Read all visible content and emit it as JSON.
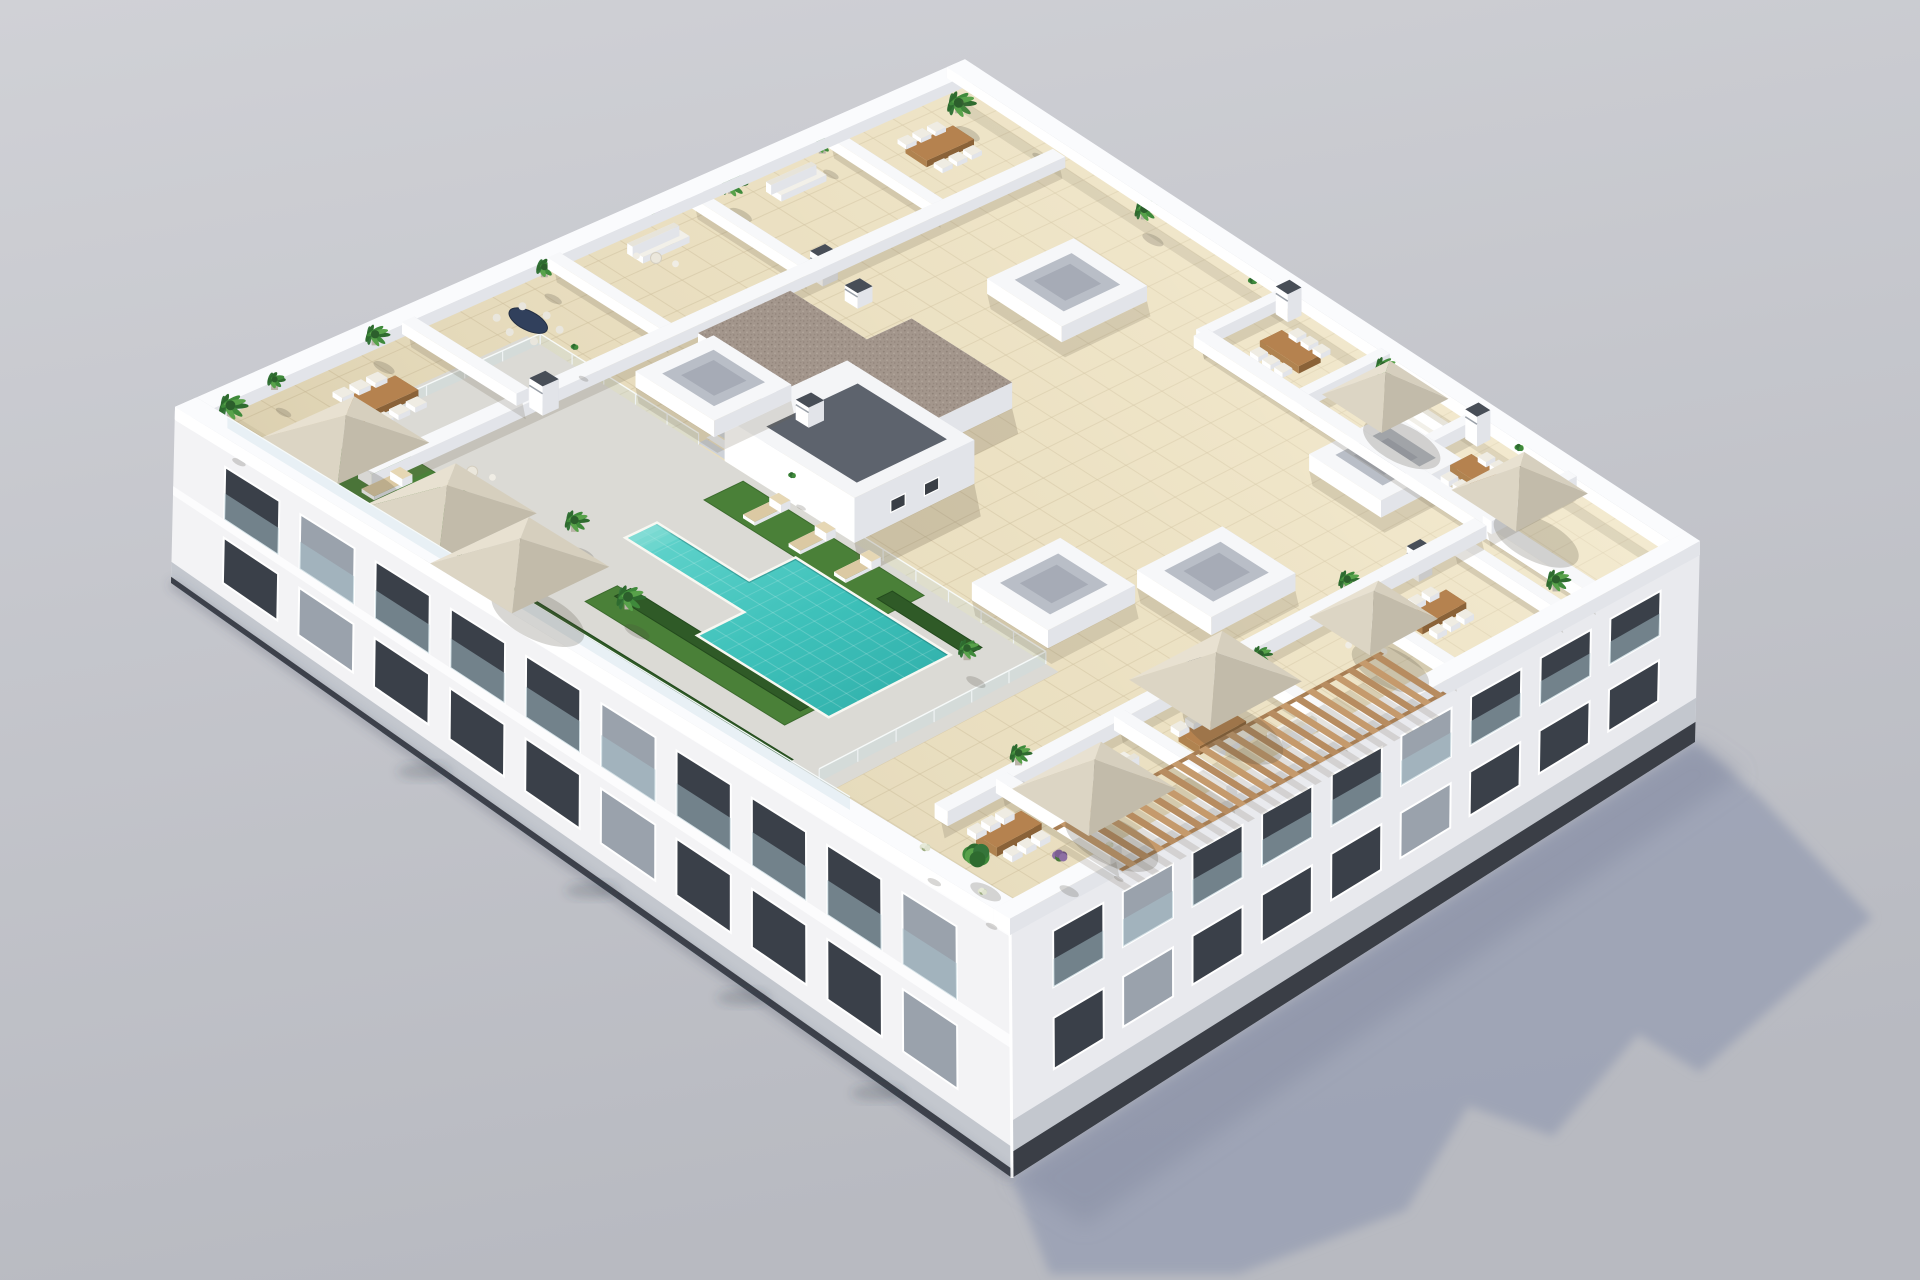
{
  "meta": {
    "description": "Aerial 3D architectural rendering of a white apartment building with a landscaped rooftop: beige tiled terraces, T-shaped turquoise pool, grass with sun loungers, canvas umbrellas, potted plants, gravel-roof stair core, slatted pergola, grey background with cast shadow to lower right",
    "visible_text": ""
  },
  "palette": {
    "background_top": "#d0d1d6",
    "background_bottom": "#b8bac1",
    "ground_shadow": "#9aa1b4",
    "wall_bright": "#ffffff",
    "wall_light": "#f1f2f6",
    "wall_shade_se": "#e2e4e9",
    "wall_shade_ne": "#d2d5dc",
    "deck_tile": "#e9debf",
    "tile_line": "#cdbf9c",
    "pool_deck": "#dbdad5",
    "pool_water": "#3ec1ba",
    "pool_water_light": "#6ad8d0",
    "grass": "#4a8038",
    "hedge": "#2f5a27",
    "gravel": "#a3968c",
    "wood": "#b5824f",
    "umbrella_canvas": "#d6cfbe",
    "glass": "#c6dee4",
    "window_glass": "#3a4049",
    "facade_base": "#c3c7ce",
    "facade_base_dark": "#3a3e46"
  },
  "projection": {
    "plan_w": 124,
    "plan_h": 100,
    "roof_screen_corners": [
      [
        175,
        420
      ],
      [
        1010,
        935
      ],
      [
        1700,
        555
      ],
      [
        965,
        70
      ]
    ],
    "ground_west": [
      171,
      583
    ],
    "ground_south": [
      1012,
      1178
    ],
    "ground_east": [
      1695,
      742
    ],
    "parapet_height": 4
  },
  "shadow_polygon": [
    [
      1012,
      1178
    ],
    [
      1695,
      742
    ],
    [
      1760,
      797
    ],
    [
      1872,
      918
    ],
    [
      1700,
      1072
    ],
    [
      1638,
      1034
    ],
    [
      1553,
      1136
    ],
    [
      1468,
      1106
    ],
    [
      1406,
      1210
    ],
    [
      1238,
      1274
    ],
    [
      1050,
      1274
    ]
  ],
  "deck": {
    "outline": [
      [
        2,
        2
      ],
      [
        122,
        2
      ],
      [
        122,
        98
      ],
      [
        2,
        98
      ]
    ],
    "grid_step": 4
  },
  "zones": {
    "pool_deck": [
      [
        10,
        1
      ],
      [
        92,
        1
      ],
      [
        92,
        34
      ],
      [
        10,
        34
      ]
    ],
    "grass": [
      [
        [
          44,
          28
        ],
        [
          72,
          28
        ],
        [
          72,
          33
        ],
        [
          44,
          33
        ]
      ],
      [
        [
          14,
          2
        ],
        [
          34,
          2
        ],
        [
          34,
          12
        ],
        [
          14,
          12
        ]
      ],
      [
        [
          50,
          8
        ],
        [
          80,
          8
        ],
        [
          80,
          12
        ],
        [
          50,
          12
        ]
      ]
    ],
    "hedges": [
      [
        [
          36,
          1.5
        ],
        [
          86,
          1.5
        ],
        [
          86,
          4
        ],
        [
          36,
          4
        ]
      ],
      [
        [
          52,
          10
        ],
        [
          80,
          10
        ],
        [
          80,
          12
        ],
        [
          52,
          12
        ]
      ],
      [
        [
          70,
          28.5
        ],
        [
          84,
          28.5
        ],
        [
          84,
          30.5
        ],
        [
          70,
          30.5
        ]
      ]
    ],
    "pool": [
      [
        44,
        22
      ],
      [
        58,
        22
      ],
      [
        58,
        28
      ],
      [
        82,
        28
      ],
      [
        82,
        12
      ],
      [
        62,
        12
      ],
      [
        62,
        18
      ],
      [
        44,
        18
      ]
    ]
  },
  "fence": {
    "segments": [
      [
        [
          12,
          6
        ],
        [
          12,
          34
        ]
      ],
      [
        [
          12,
          34
        ],
        [
          36,
          34
        ]
      ],
      [
        [
          44,
          34
        ],
        [
          90,
          34
        ]
      ],
      [
        [
          90,
          34
        ],
        [
          90,
          4
        ]
      ]
    ],
    "height": 3.4,
    "post_step": 5
  },
  "stairs": {
    "a0": 36,
    "a1": 44,
    "b_top": 40,
    "steps": 6
  },
  "walls": {
    "height": 3.8,
    "inner": [
      {
        "seg": [
          [
            20,
            6
          ],
          [
            20,
            96
          ]
        ],
        "t": 2
      },
      {
        "seg": [
          [
            2,
            26
          ],
          [
            19,
            26
          ]
        ],
        "t": 1.5
      },
      {
        "seg": [
          [
            2,
            44
          ],
          [
            19,
            44
          ]
        ],
        "t": 1.5
      },
      {
        "seg": [
          [
            2,
            62
          ],
          [
            19,
            62
          ]
        ],
        "t": 1.5
      },
      {
        "seg": [
          [
            2,
            80
          ],
          [
            19,
            80
          ]
        ],
        "t": 1.5
      },
      {
        "seg": [
          [
            56,
            85
          ],
          [
            122,
            85
          ]
        ],
        "t": 2
      },
      {
        "seg": [
          [
            56,
            85
          ],
          [
            56,
            98
          ]
        ],
        "t": 1.5
      },
      {
        "seg": [
          [
            72,
            85
          ],
          [
            72,
            98
          ]
        ],
        "t": 1.5
      },
      {
        "seg": [
          [
            88,
            85
          ],
          [
            88,
            98
          ]
        ],
        "t": 1.5
      },
      {
        "seg": [
          [
            104,
            85
          ],
          [
            104,
            98
          ]
        ],
        "t": 1.5
      },
      {
        "seg": [
          [
            104,
            8
          ],
          [
            104,
            84
          ]
        ],
        "t": 2
      },
      {
        "seg": [
          [
            104,
            16
          ],
          [
            122,
            16
          ]
        ],
        "t": 1.5
      },
      {
        "seg": [
          [
            104,
            32
          ],
          [
            122,
            32
          ]
        ],
        "t": 1.5
      },
      {
        "seg": [
          [
            104,
            48
          ],
          [
            122,
            48
          ]
        ],
        "t": 1.5
      },
      {
        "seg": [
          [
            104,
            64
          ],
          [
            122,
            64
          ]
        ],
        "t": 1.5
      },
      {
        "seg": [
          [
            104,
            80
          ],
          [
            122,
            80
          ]
        ],
        "t": 1.5
      }
    ]
  },
  "parapet": [
    [
      0,
      0,
      124,
      2.5
    ],
    [
      0,
      0,
      2.5,
      100
    ],
    [
      0,
      97.5,
      124,
      100
    ],
    [
      121.5,
      0,
      124,
      100
    ]
  ],
  "boxes": [
    [
      24,
      36,
      36,
      46
    ],
    [
      82,
      78,
      94,
      90
    ],
    [
      34,
      74,
      46,
      86
    ],
    [
      76,
      36,
      88,
      48
    ],
    [
      86,
      50,
      98,
      62
    ]
  ],
  "core": {
    "gravel_outline": [
      [
        24,
        44
      ],
      [
        52,
        44
      ],
      [
        52,
        62
      ],
      [
        36,
        62
      ],
      [
        36,
        56
      ],
      [
        24,
        56
      ]
    ],
    "height": 8,
    "tower_rect": [
      40,
      34,
      60,
      50
    ],
    "tower_height": 13,
    "panel_rect": [
      44,
      36,
      58,
      48
    ]
  },
  "pergola": {
    "a0": 115.5,
    "a1": 126.5,
    "b0": 14,
    "b1": 58,
    "slat_step": 1.9,
    "slat_w": 0.95,
    "height": 5
  },
  "umbrellas": [
    {
      "c": [
        16,
        7
      ],
      "s": 11
    },
    {
      "c": [
        32,
        6
      ],
      "s": 12
    },
    {
      "c": [
        44,
        5
      ],
      "s": 12
    },
    {
      "c": [
        80,
        91
      ],
      "s": 10
    },
    {
      "c": [
        104,
        90
      ],
      "s": 11
    },
    {
      "c": [
        114,
        20
      ],
      "s": 12
    },
    {
      "c": [
        108,
        42
      ],
      "s": 13
    },
    {
      "c": [
        111,
        62
      ],
      "s": 10
    }
  ],
  "tables": [
    {
      "c": [
        10,
        16
      ],
      "w": 3.4,
      "d": 6.5
    },
    {
      "c": [
        10,
        88
      ],
      "w": 3.4,
      "d": 6.5
    },
    {
      "c": [
        64,
        91
      ],
      "w": 6.5,
      "d": 3.2
    },
    {
      "c": [
        96,
        91
      ],
      "w": 6.5,
      "d": 3.2
    },
    {
      "c": [
        112,
        38
      ],
      "w": 3.4,
      "d": 6.5
    },
    {
      "c": [
        112,
        70
      ],
      "w": 3.4,
      "d": 6.5
    },
    {
      "c": [
        111,
        11
      ],
      "w": 3.2,
      "d": 6
    }
  ],
  "oval_table": {
    "c": [
      9,
      35
    ]
  },
  "round_tables": [
    [
      8,
      52
    ],
    [
      86,
      90
    ],
    [
      26,
      14
    ],
    [
      112,
      60
    ]
  ],
  "sofas": [
    {
      "c": [
        6,
        54
      ],
      "w": 2.4,
      "d": 6,
      "back": "-a"
    },
    {
      "c": [
        6,
        72
      ],
      "w": 2.4,
      "d": 6,
      "back": "-a"
    },
    {
      "c": [
        84,
        93
      ],
      "w": 6,
      "d": 2.4,
      "back": "+b"
    },
    {
      "c": [
        110,
        26
      ],
      "w": 2.4,
      "d": 5,
      "back": "+a"
    },
    {
      "c": [
        118,
        44
      ],
      "w": 2.4,
      "d": 5,
      "back": "+a"
    }
  ],
  "loungers": [
    [
      50,
      31
    ],
    [
      57,
      31
    ],
    [
      64,
      31
    ],
    [
      22,
      7
    ],
    [
      27,
      9
    ]
  ],
  "chimneys": [
    {
      "c": [
        21,
        27
      ],
      "h": 9
    },
    {
      "c": [
        21,
        63
      ],
      "h": 9
    },
    {
      "c": [
        58,
        96
      ],
      "h": 9
    },
    {
      "c": [
        90,
        96
      ],
      "h": 9
    },
    {
      "c": [
        105,
        42
      ],
      "h": 8
    },
    {
      "c": [
        105,
        74
      ],
      "h": 8
    },
    {
      "c": [
        30,
        60
      ],
      "h": 5,
      "z0": 8
    },
    {
      "c": [
        46,
        40
      ],
      "h": 6,
      "z0": 13
    }
  ],
  "plants": [
    {
      "c": [
        3,
        4
      ],
      "t": "palm",
      "s": 13
    },
    {
      "c": [
        6,
        1.5
      ],
      "t": "bush",
      "s": 7
    },
    {
      "c": [
        2,
        10
      ],
      "t": "green",
      "s": 8
    },
    {
      "c": [
        2,
        22
      ],
      "t": "palm",
      "s": 11
    },
    {
      "c": [
        3,
        42
      ],
      "t": "green",
      "s": 9
    },
    {
      "c": [
        2,
        57
      ],
      "t": "purple",
      "s": 11
    },
    {
      "c": [
        3,
        66
      ],
      "t": "palm",
      "s": 12
    },
    {
      "c": [
        3,
        78
      ],
      "t": "green",
      "s": 8
    },
    {
      "c": [
        6,
        94
      ],
      "t": "palm",
      "s": 13
    },
    {
      "c": [
        14,
        97
      ],
      "t": "bush",
      "s": 6
    },
    {
      "c": [
        34,
        96
      ],
      "t": "palm",
      "s": 11
    },
    {
      "c": [
        52,
        96
      ],
      "t": "bush",
      "s": 6
    },
    {
      "c": [
        74,
        96
      ],
      "t": "palm",
      "s": 10
    },
    {
      "c": [
        96,
        97
      ],
      "t": "bush",
      "s": 6
    },
    {
      "c": [
        118,
        83
      ],
      "t": "palm",
      "s": 11
    },
    {
      "c": [
        102,
        20
      ],
      "t": "palm",
      "s": 10
    },
    {
      "c": [
        106,
        50
      ],
      "t": "palm",
      "s": 9
    },
    {
      "c": [
        102,
        66
      ],
      "t": "palm",
      "s": 10
    },
    {
      "c": [
        113,
        5
      ],
      "t": "tree",
      "s": 16
    },
    {
      "c": [
        119,
        11
      ],
      "t": "purple",
      "s": 10
    },
    {
      "c": [
        108,
        2.5
      ],
      "t": "white",
      "s": 7
    },
    {
      "c": [
        118,
        1.5
      ],
      "t": "white",
      "s": 6
    },
    {
      "c": [
        121,
        16
      ],
      "t": "white",
      "s": 5
    },
    {
      "c": [
        54,
        10
      ],
      "t": "palm",
      "s": 13
    },
    {
      "c": [
        40,
        15
      ],
      "t": "palm",
      "s": 11
    },
    {
      "c": [
        84,
        28.5
      ],
      "t": "palm",
      "s": 10
    },
    {
      "c": [
        48,
        36
      ],
      "t": "bush",
      "s": 5
    },
    {
      "c": [
        16,
        35
      ],
      "t": "bush",
      "s": 5
    }
  ],
  "facade_sw": {
    "cols": 10,
    "u0": 0.05,
    "u1": 0.95,
    "rows": [
      {
        "v0": 0.16,
        "v1": 0.45
      },
      {
        "v0": 0.55,
        "v1": 0.8
      }
    ],
    "cornice": [
      0.02,
      0.07
    ],
    "balcony_band": [
      0.45,
      0.5
    ],
    "base_band": [
      0.88,
      1.0
    ],
    "base_dark": [
      0.965,
      1.0
    ]
  },
  "facade_se": {
    "cols": 9,
    "u0": 0.05,
    "u1": 0.96,
    "rows": [
      {
        "v0": 0.14,
        "v1": 0.36
      },
      {
        "v0": 0.48,
        "v1": 0.68
      }
    ],
    "cornice": [
      0.02,
      0.06
    ],
    "base_band": [
      0.78,
      1.0
    ],
    "base_dark": [
      0.9,
      1.0
    ]
  }
}
